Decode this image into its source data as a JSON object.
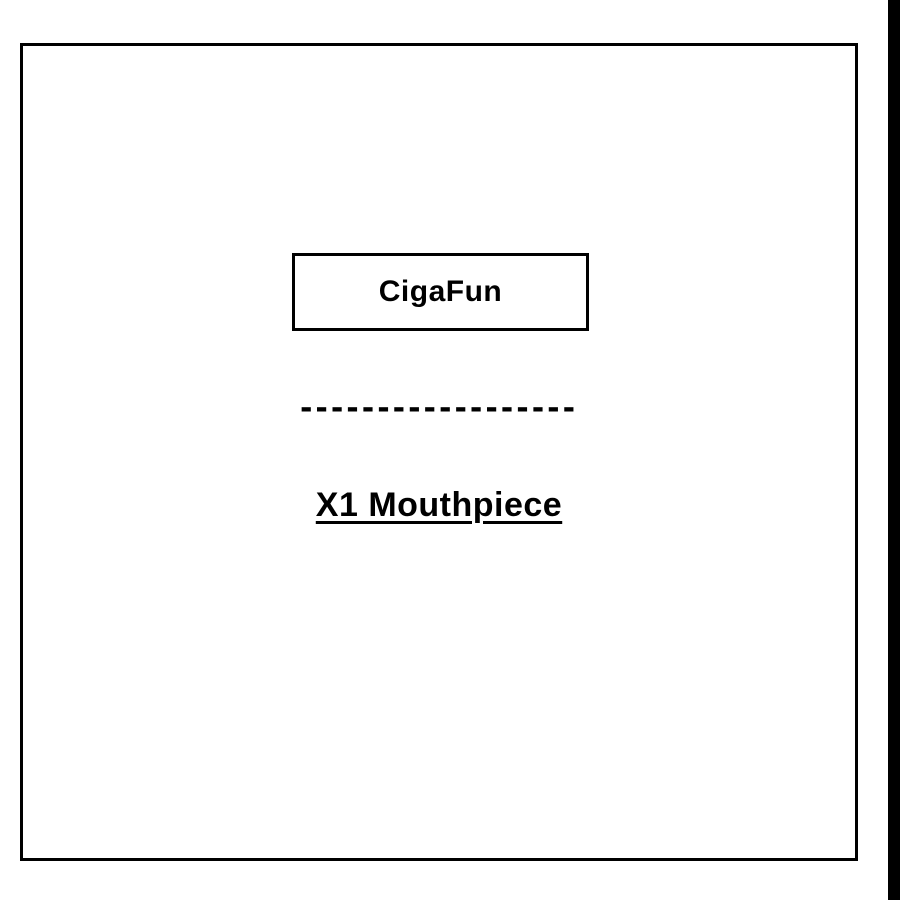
{
  "colors": {
    "ink": "#000000",
    "background": "#ffffff"
  },
  "canvas": {
    "brand_label": "CigaFun",
    "divider_dashes": "------------------",
    "product_label": "X1 Mouthpiece"
  }
}
